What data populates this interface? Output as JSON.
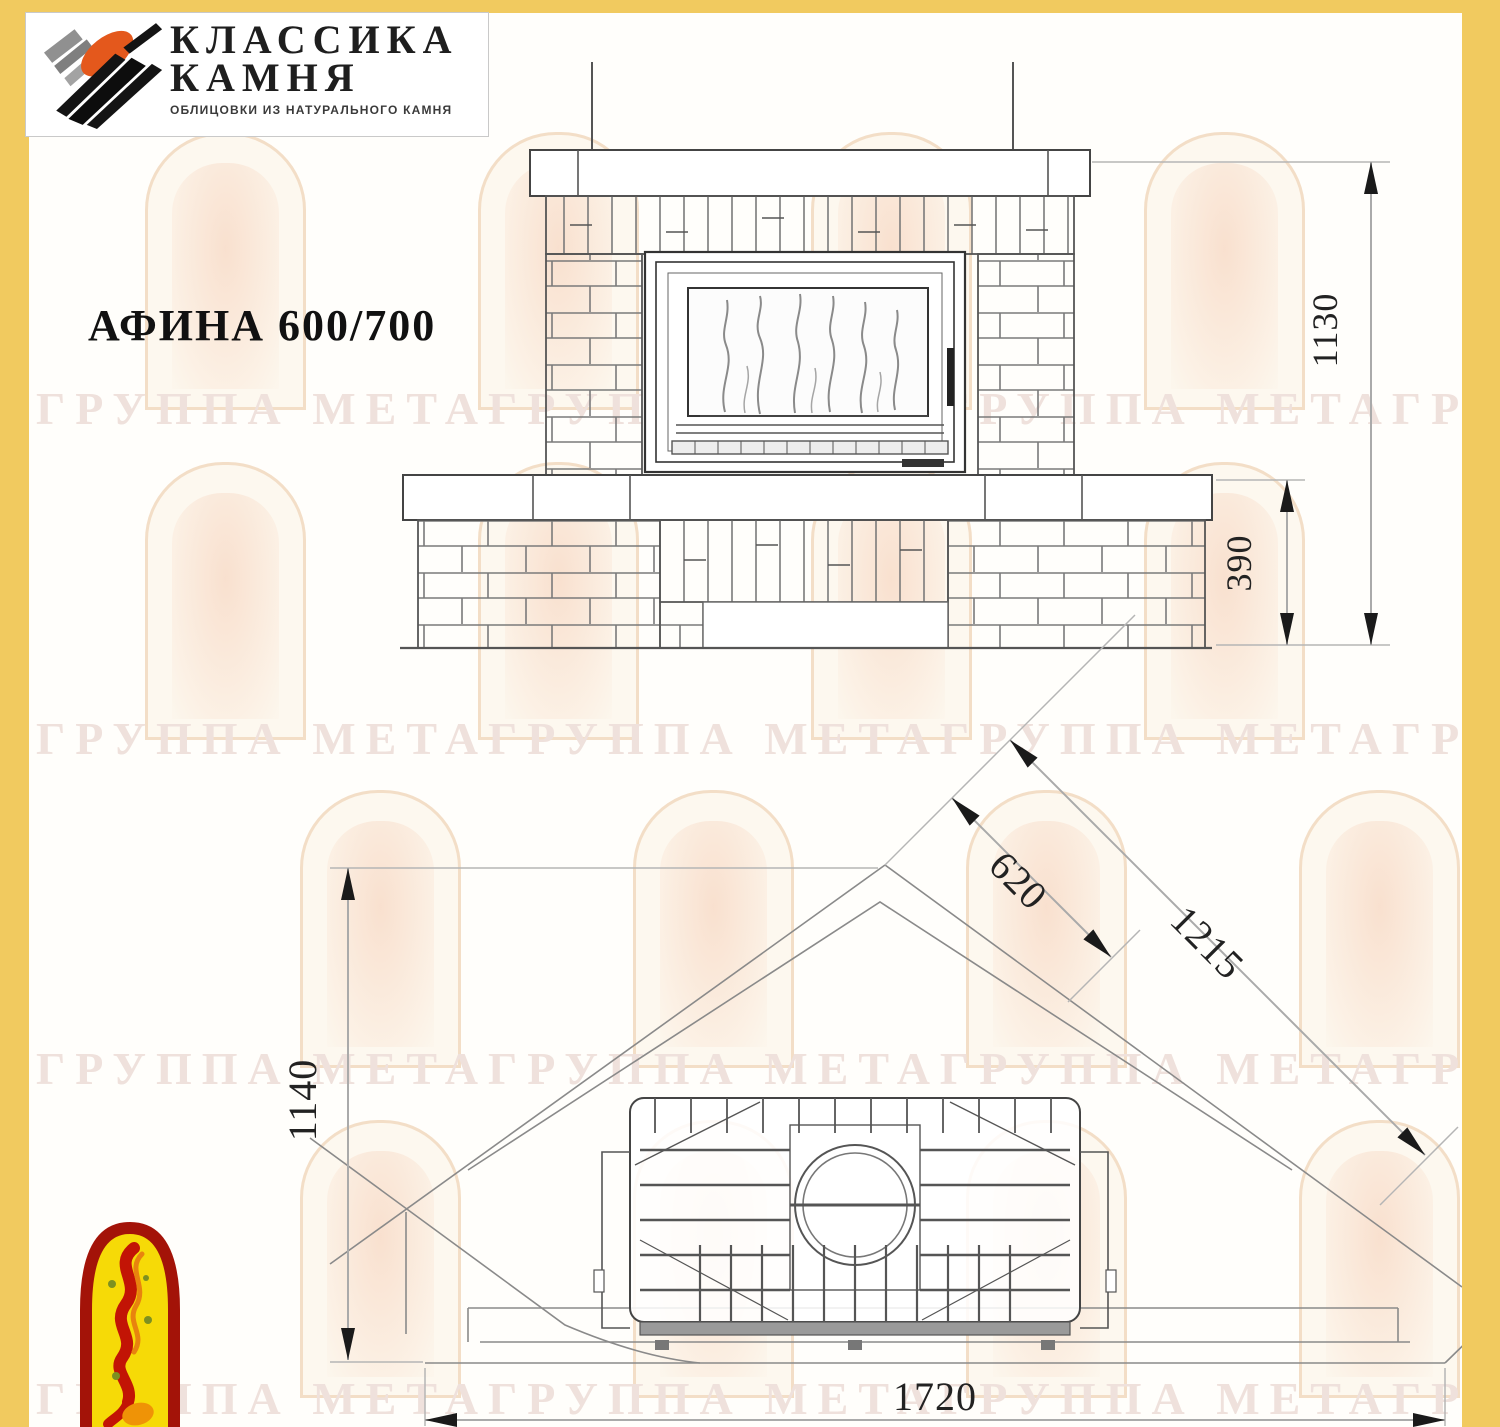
{
  "brand": {
    "name_line1": "КЛАССИКА",
    "name_line2": "КАМНЯ",
    "subtitle": "ОБЛИЦОВКИ ИЗ НАТУРАЛЬНОГО КАМНЯ"
  },
  "title": "АФИНА 600/700",
  "watermark": {
    "row_text": "ГРУППА МЕТАГРУППА МЕТАГРУППА МЕТАГРУППА МЕТА"
  },
  "front_view": {
    "label": "front elevation of fireplace",
    "dim_total_height": "1130",
    "dim_bench_height": "390"
  },
  "plan_view": {
    "label": "plan view of corner fireplace",
    "dim_firebox_width": "620",
    "dim_side_wall": "1215",
    "dim_depth": "1140",
    "dim_front_width": "1720"
  },
  "colors": {
    "page_border_yellow": "#f1ca5f",
    "logo_orange": "#e4581c",
    "logo_black": "#111111",
    "logo_gray": "#8f8f8f",
    "emblem_red": "#a31308",
    "emblem_yellow": "#f6da07",
    "drawing_line": "#555555",
    "dimension_text": "#222222",
    "watermark_text": "#efe1dc"
  }
}
